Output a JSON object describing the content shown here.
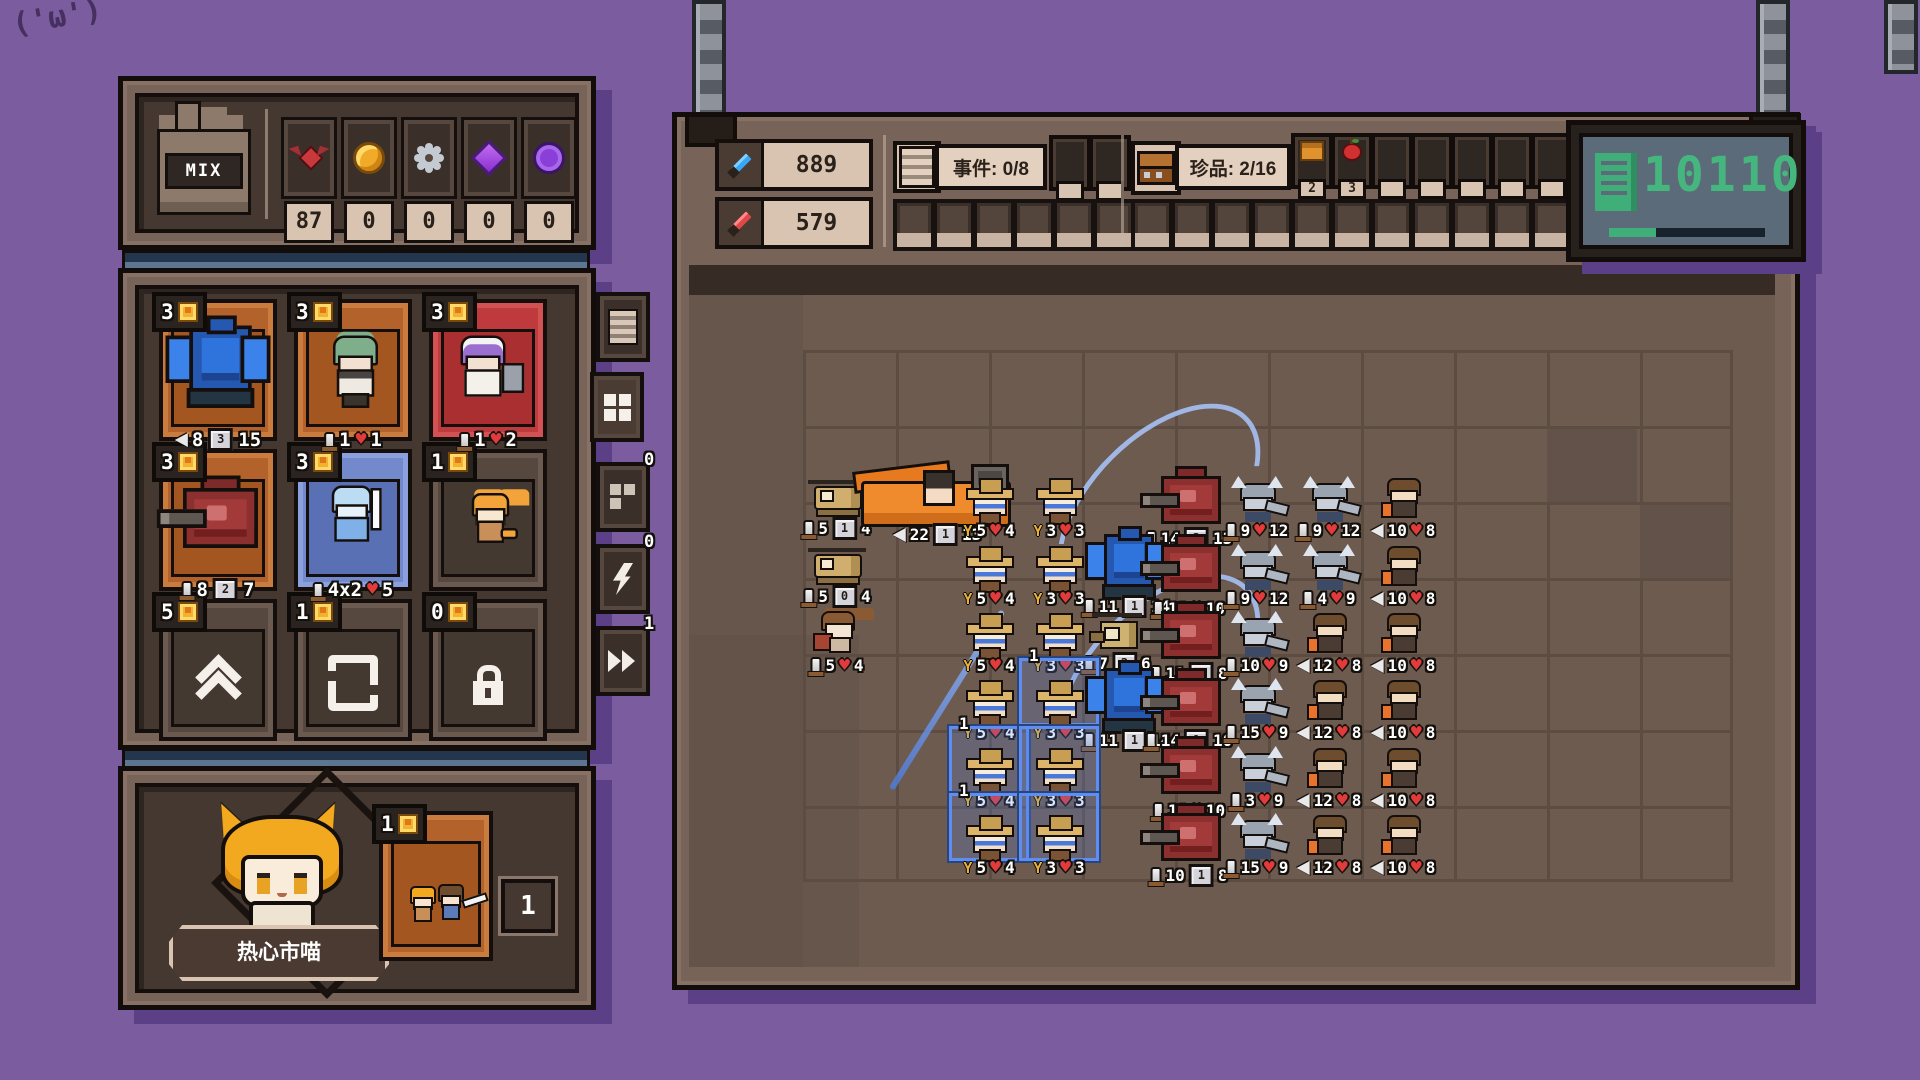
{
  "doodle": "('ω')",
  "mix": {
    "label": "MIX"
  },
  "resources": {
    "items": [
      {
        "icon": "bat",
        "value": "87"
      },
      {
        "icon": "coin",
        "value": "0"
      },
      {
        "icon": "gear",
        "value": "0"
      },
      {
        "icon": "gem",
        "value": "0"
      },
      {
        "icon": "token",
        "value": "0"
      }
    ]
  },
  "shop": {
    "cards": [
      {
        "name": "blue-mech-card",
        "cost": "3",
        "style": "orange",
        "sprite": "bluemech",
        "stats": [
          [
            "r",
            "8"
          ],
          [
            "s",
            "3"
          ],
          [
            "p",
            "15"
          ]
        ]
      },
      {
        "name": "green-maid-card",
        "cost": "3",
        "style": "orange",
        "sprite": "maidgreen",
        "stats": [
          [
            "m",
            "1"
          ],
          [
            "h",
            "1"
          ]
        ]
      },
      {
        "name": "purple-maid-card",
        "cost": "3",
        "style": "red",
        "sprite": "maidpurple",
        "stats": [
          [
            "m",
            "1"
          ],
          [
            "h",
            "2"
          ]
        ]
      },
      {
        "name": "red-mech-card",
        "cost": "3",
        "style": "orange",
        "sprite": "redmech",
        "stats": [
          [
            "m",
            "8"
          ],
          [
            "s",
            "2"
          ],
          [
            "p",
            "7"
          ]
        ]
      },
      {
        "name": "ice-knight-card",
        "cost": "3",
        "style": "blue",
        "sprite": "iceknight",
        "stats": [
          [
            "m",
            "4x2"
          ],
          [
            "h",
            "5"
          ]
        ]
      },
      {
        "name": "orange-cat-card",
        "cost": "1",
        "style": "dark",
        "sprite": "orangecat",
        "stats": []
      },
      {
        "name": "upgrade-card",
        "cost": "5",
        "style": "dark",
        "glyph": "upgrade",
        "stats": []
      },
      {
        "name": "reroll-card",
        "cost": "1",
        "style": "dark",
        "glyph": "reroll",
        "stats": []
      },
      {
        "name": "lock-card",
        "cost": "0",
        "style": "dark",
        "glyph": "lock",
        "stats": []
      }
    ],
    "tabs": [
      {
        "name": "tab-log",
        "icon": "doc",
        "badge": ""
      },
      {
        "name": "tab-roster",
        "icon": "grid",
        "badge": ""
      },
      {
        "name": "tab-storage",
        "icon": "boxes",
        "badge": "0"
      },
      {
        "name": "tab-energy",
        "icon": "bolt",
        "badge": "0"
      },
      {
        "name": "tab-speed",
        "icon": "ff",
        "badge": "1"
      }
    ]
  },
  "player": {
    "name": "热心市喵",
    "card_cost": "1",
    "card_count": "1"
  },
  "battle_header": {
    "attack_total": "889",
    "defense_total": "579",
    "event_label": "事件: 0/8",
    "treasure_label": "珍品: 2/16",
    "treasure_items": [
      {
        "icon": "bag",
        "count": "2"
      },
      {
        "icon": "apple",
        "count": "3"
      }
    ],
    "event_slots_top": 2,
    "event_slots_bottom": 6,
    "treasure_slots_top": 7,
    "treasure_slots_bottom": 11,
    "display_value": "10110",
    "display_progress_pct": 30
  },
  "battlefield": {
    "rows": [
      {
        "y": 455,
        "units": [
          {
            "t": "heli",
            "x": 800,
            "st": [
              [
                "m",
                "5"
              ],
              [
                "s",
                "1"
              ],
              [
                "p",
                "4"
              ]
            ]
          },
          {
            "t": "truck",
            "x": 856,
            "st": [
              [
                "r",
                "22"
              ],
              [
                "s",
                "1"
              ],
              [
                "p",
                "13"
              ]
            ]
          },
          {
            "t": "cowboy",
            "x": 952,
            "st": [
              [
                "w",
                "5"
              ],
              [
                "h",
                "4"
              ]
            ]
          },
          {
            "t": "cowboy",
            "x": 1022,
            "st": [
              [
                "w",
                "3"
              ],
              [
                "h",
                "3"
              ]
            ]
          },
          {
            "t": "redmech",
            "x": 1142,
            "st": [
              [
                "m",
                "14"
              ],
              [
                "s",
                "2"
              ],
              [
                "p",
                "13"
              ]
            ]
          },
          {
            "t": "viking",
            "x": 1220,
            "st": [
              [
                "m",
                "9"
              ],
              [
                "h",
                "12"
              ]
            ]
          },
          {
            "t": "viking",
            "x": 1292,
            "st": [
              [
                "m",
                "9"
              ],
              [
                "h",
                "12"
              ]
            ]
          },
          {
            "t": "archer",
            "x": 1366,
            "st": [
              [
                "r",
                "10"
              ],
              [
                "h",
                "8"
              ]
            ]
          }
        ]
      },
      {
        "y": 523,
        "units": [
          {
            "t": "heli",
            "x": 800,
            "st": [
              [
                "m",
                "5"
              ],
              [
                "s",
                "0"
              ],
              [
                "p",
                "4"
              ]
            ]
          },
          {
            "t": "cowboy",
            "x": 952,
            "st": [
              [
                "w",
                "5"
              ],
              [
                "h",
                "4"
              ]
            ]
          },
          {
            "t": "cowboy",
            "x": 1022,
            "st": [
              [
                "w",
                "3"
              ],
              [
                "h",
                "3"
              ]
            ]
          },
          {
            "t": "bluemech",
            "x": 1080,
            "st": [
              [
                "m",
                "11"
              ],
              [
                "s",
                "1"
              ],
              [
                "p",
                "14"
              ]
            ]
          },
          {
            "t": "redmech",
            "x": 1142,
            "st": [
              [
                "m",
                "18"
              ],
              [
                "h",
                "10"
              ]
            ]
          },
          {
            "t": "viking",
            "x": 1220,
            "st": [
              [
                "m",
                "9"
              ],
              [
                "h",
                "12"
              ]
            ]
          },
          {
            "t": "viking",
            "x": 1292,
            "st": [
              [
                "m",
                "4"
              ],
              [
                "h",
                "9"
              ]
            ]
          },
          {
            "t": "archer",
            "x": 1366,
            "st": [
              [
                "r",
                "10"
              ],
              [
                "h",
                "8"
              ]
            ]
          }
        ]
      },
      {
        "y": 590,
        "units": [
          {
            "t": "catgirl",
            "x": 800,
            "st": [
              [
                "m",
                "5"
              ],
              [
                "h",
                "4"
              ]
            ]
          },
          {
            "t": "cowboy",
            "x": 952,
            "st": [
              [
                "w",
                "5"
              ],
              [
                "h",
                "4"
              ]
            ]
          },
          {
            "t": "cowboy",
            "x": 1022,
            "st": [
              [
                "w",
                "3"
              ],
              [
                "h",
                "3"
              ]
            ]
          },
          {
            "t": "drone",
            "x": 1080,
            "st": [
              [
                "m",
                "7"
              ],
              [
                "s",
                "2"
              ],
              [
                "p",
                "6"
              ]
            ]
          },
          {
            "t": "redmech",
            "x": 1142,
            "st": [
              [
                "m",
                "11"
              ],
              [
                "s",
                "2"
              ],
              [
                "p",
                "8"
              ]
            ]
          },
          {
            "t": "viking",
            "x": 1220,
            "st": [
              [
                "m",
                "10"
              ],
              [
                "h",
                "9"
              ]
            ]
          },
          {
            "t": "archer",
            "x": 1292,
            "st": [
              [
                "r",
                "12"
              ],
              [
                "h",
                "8"
              ]
            ]
          },
          {
            "t": "archer",
            "x": 1366,
            "st": [
              [
                "r",
                "10"
              ],
              [
                "h",
                "8"
              ]
            ]
          }
        ]
      },
      {
        "y": 657,
        "units": [
          {
            "t": "cowboy",
            "x": 952,
            "st": [
              [
                "w",
                "5"
              ],
              [
                "h",
                "4"
              ]
            ]
          },
          {
            "t": "cowboy",
            "x": 1022,
            "st": [
              [
                "w",
                "3"
              ],
              [
                "h",
                "3"
              ]
            ],
            "frame": true,
            "tag": "1"
          },
          {
            "t": "bluemech",
            "x": 1080,
            "st": [
              [
                "m",
                "11"
              ],
              [
                "s",
                "1"
              ],
              [
                "p",
                "14"
              ]
            ]
          },
          {
            "t": "redmech",
            "x": 1142,
            "st": [
              [
                "m",
                "14"
              ],
              [
                "s",
                "1"
              ],
              [
                "p",
                "10"
              ]
            ]
          },
          {
            "t": "viking",
            "x": 1220,
            "st": [
              [
                "m",
                "15"
              ],
              [
                "h",
                "9"
              ]
            ]
          },
          {
            "t": "archer",
            "x": 1292,
            "st": [
              [
                "r",
                "12"
              ],
              [
                "h",
                "8"
              ]
            ]
          },
          {
            "t": "archer",
            "x": 1366,
            "st": [
              [
                "r",
                "10"
              ],
              [
                "h",
                "8"
              ]
            ]
          }
        ]
      },
      {
        "y": 725,
        "units": [
          {
            "t": "cowboy",
            "x": 952,
            "st": [
              [
                "w",
                "5"
              ],
              [
                "h",
                "4"
              ]
            ],
            "frame": true,
            "tag": "1"
          },
          {
            "t": "cowboy",
            "x": 1022,
            "st": [
              [
                "w",
                "3"
              ],
              [
                "h",
                "3"
              ]
            ],
            "frame": true
          },
          {
            "t": "redmech",
            "x": 1142,
            "st": [
              [
                "m",
                "18"
              ],
              [
                "h",
                "10"
              ]
            ]
          },
          {
            "t": "viking",
            "x": 1220,
            "st": [
              [
                "m",
                "3"
              ],
              [
                "h",
                "9"
              ]
            ]
          },
          {
            "t": "archer",
            "x": 1292,
            "st": [
              [
                "r",
                "12"
              ],
              [
                "h",
                "8"
              ]
            ]
          },
          {
            "t": "archer",
            "x": 1366,
            "st": [
              [
                "r",
                "10"
              ],
              [
                "h",
                "8"
              ]
            ]
          }
        ]
      },
      {
        "y": 792,
        "units": [
          {
            "t": "cowboy",
            "x": 952,
            "st": [
              [
                "w",
                "5"
              ],
              [
                "h",
                "4"
              ]
            ],
            "frame": true,
            "tag": "1"
          },
          {
            "t": "cowboy",
            "x": 1022,
            "st": [
              [
                "w",
                "3"
              ],
              [
                "h",
                "3"
              ]
            ],
            "frame": true
          },
          {
            "t": "redmech",
            "x": 1142,
            "st": [
              [
                "m",
                "10"
              ],
              [
                "s",
                "1"
              ],
              [
                "p",
                "8"
              ]
            ]
          },
          {
            "t": "viking",
            "x": 1220,
            "st": [
              [
                "m",
                "15"
              ],
              [
                "h",
                "9"
              ]
            ]
          },
          {
            "t": "archer",
            "x": 1292,
            "st": [
              [
                "r",
                "12"
              ],
              [
                "h",
                "8"
              ]
            ]
          },
          {
            "t": "archer",
            "x": 1366,
            "st": [
              [
                "r",
                "10"
              ],
              [
                "h",
                "8"
              ]
            ]
          }
        ]
      }
    ]
  },
  "colors": {
    "background": "#7b5c9e",
    "panel_shadow": "#5b4088",
    "panel_brown": "#776357",
    "panel_dark": "#453830",
    "beige": "#d9c4b2",
    "accent_green": "#45b77e",
    "card_orange": "#b4622c",
    "card_red": "#bf3a3c",
    "card_blue": "#7289cc",
    "heart_red": "#e23b3b",
    "atk_blue": "#38a6f4",
    "atk_red": "#e04848"
  }
}
